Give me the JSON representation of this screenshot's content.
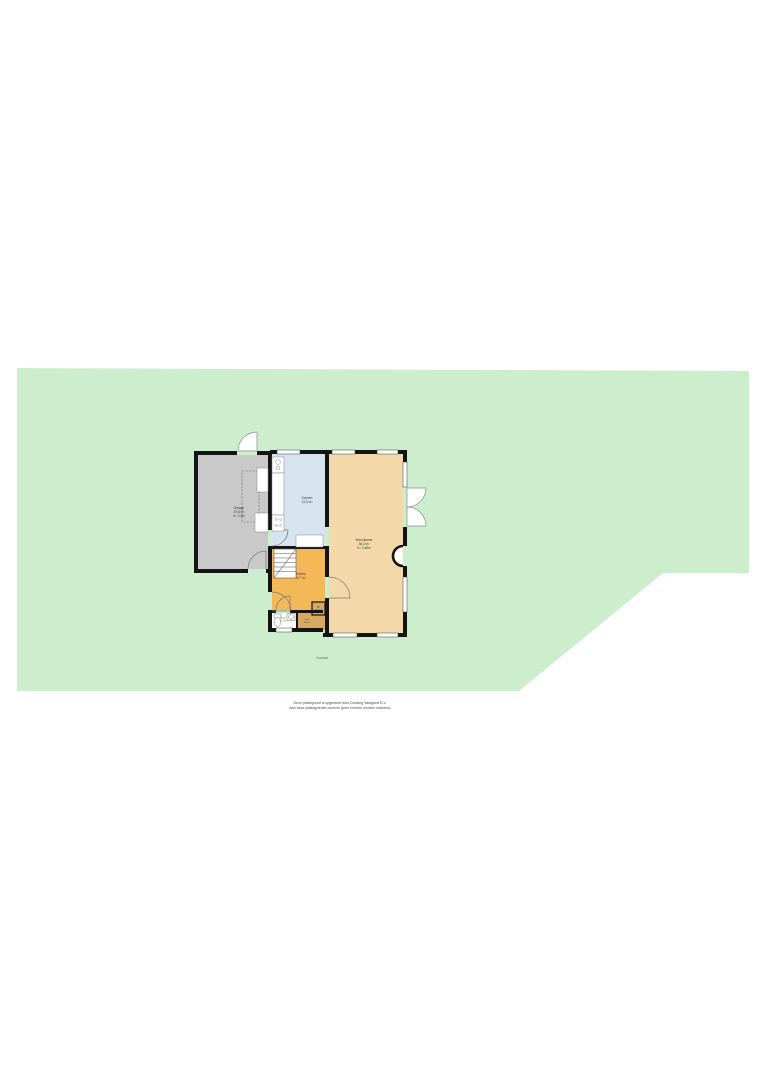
{
  "lot": {
    "fill": "#cdeecd",
    "garden_label": "Voortuin"
  },
  "rooms": {
    "garage": {
      "name": "Garage",
      "area": "19,8 m²",
      "height": "h= 2,4m",
      "fill": "#c9c9c9"
    },
    "keuken": {
      "name": "Keuken",
      "area": "12,6 m²",
      "fill": "#d6e4f0"
    },
    "woonkamer": {
      "name": "Woonkamer",
      "area": "36,3 m²",
      "height": "h= 2,48m",
      "fill": "#f3d9a9"
    },
    "entree": {
      "name": "Entree",
      "area": "5,7 m²",
      "fill": "#f4b858"
    },
    "toilet": {
      "name": "Toilet",
      "area": "1,1 m²",
      "fill": "#ffffff"
    },
    "kast": {
      "name": "Kast",
      "area": "0,8 m²",
      "fill": "#d8a95e"
    },
    "mk": {
      "name": "MK",
      "area": "0,4 m²",
      "fill": "#d8a95e"
    }
  },
  "colors": {
    "wall": "#141414",
    "window_frame": "#3a3a3a",
    "door_stroke": "#8a8a8a",
    "fixture_stroke": "#777777"
  },
  "caption": {
    "line1": "Deze plattegrond is opgesteld door Docking Vastgoed B.V.",
    "line2": "Aan deze plattegronden kunnen geen rechten worden ontleend."
  }
}
